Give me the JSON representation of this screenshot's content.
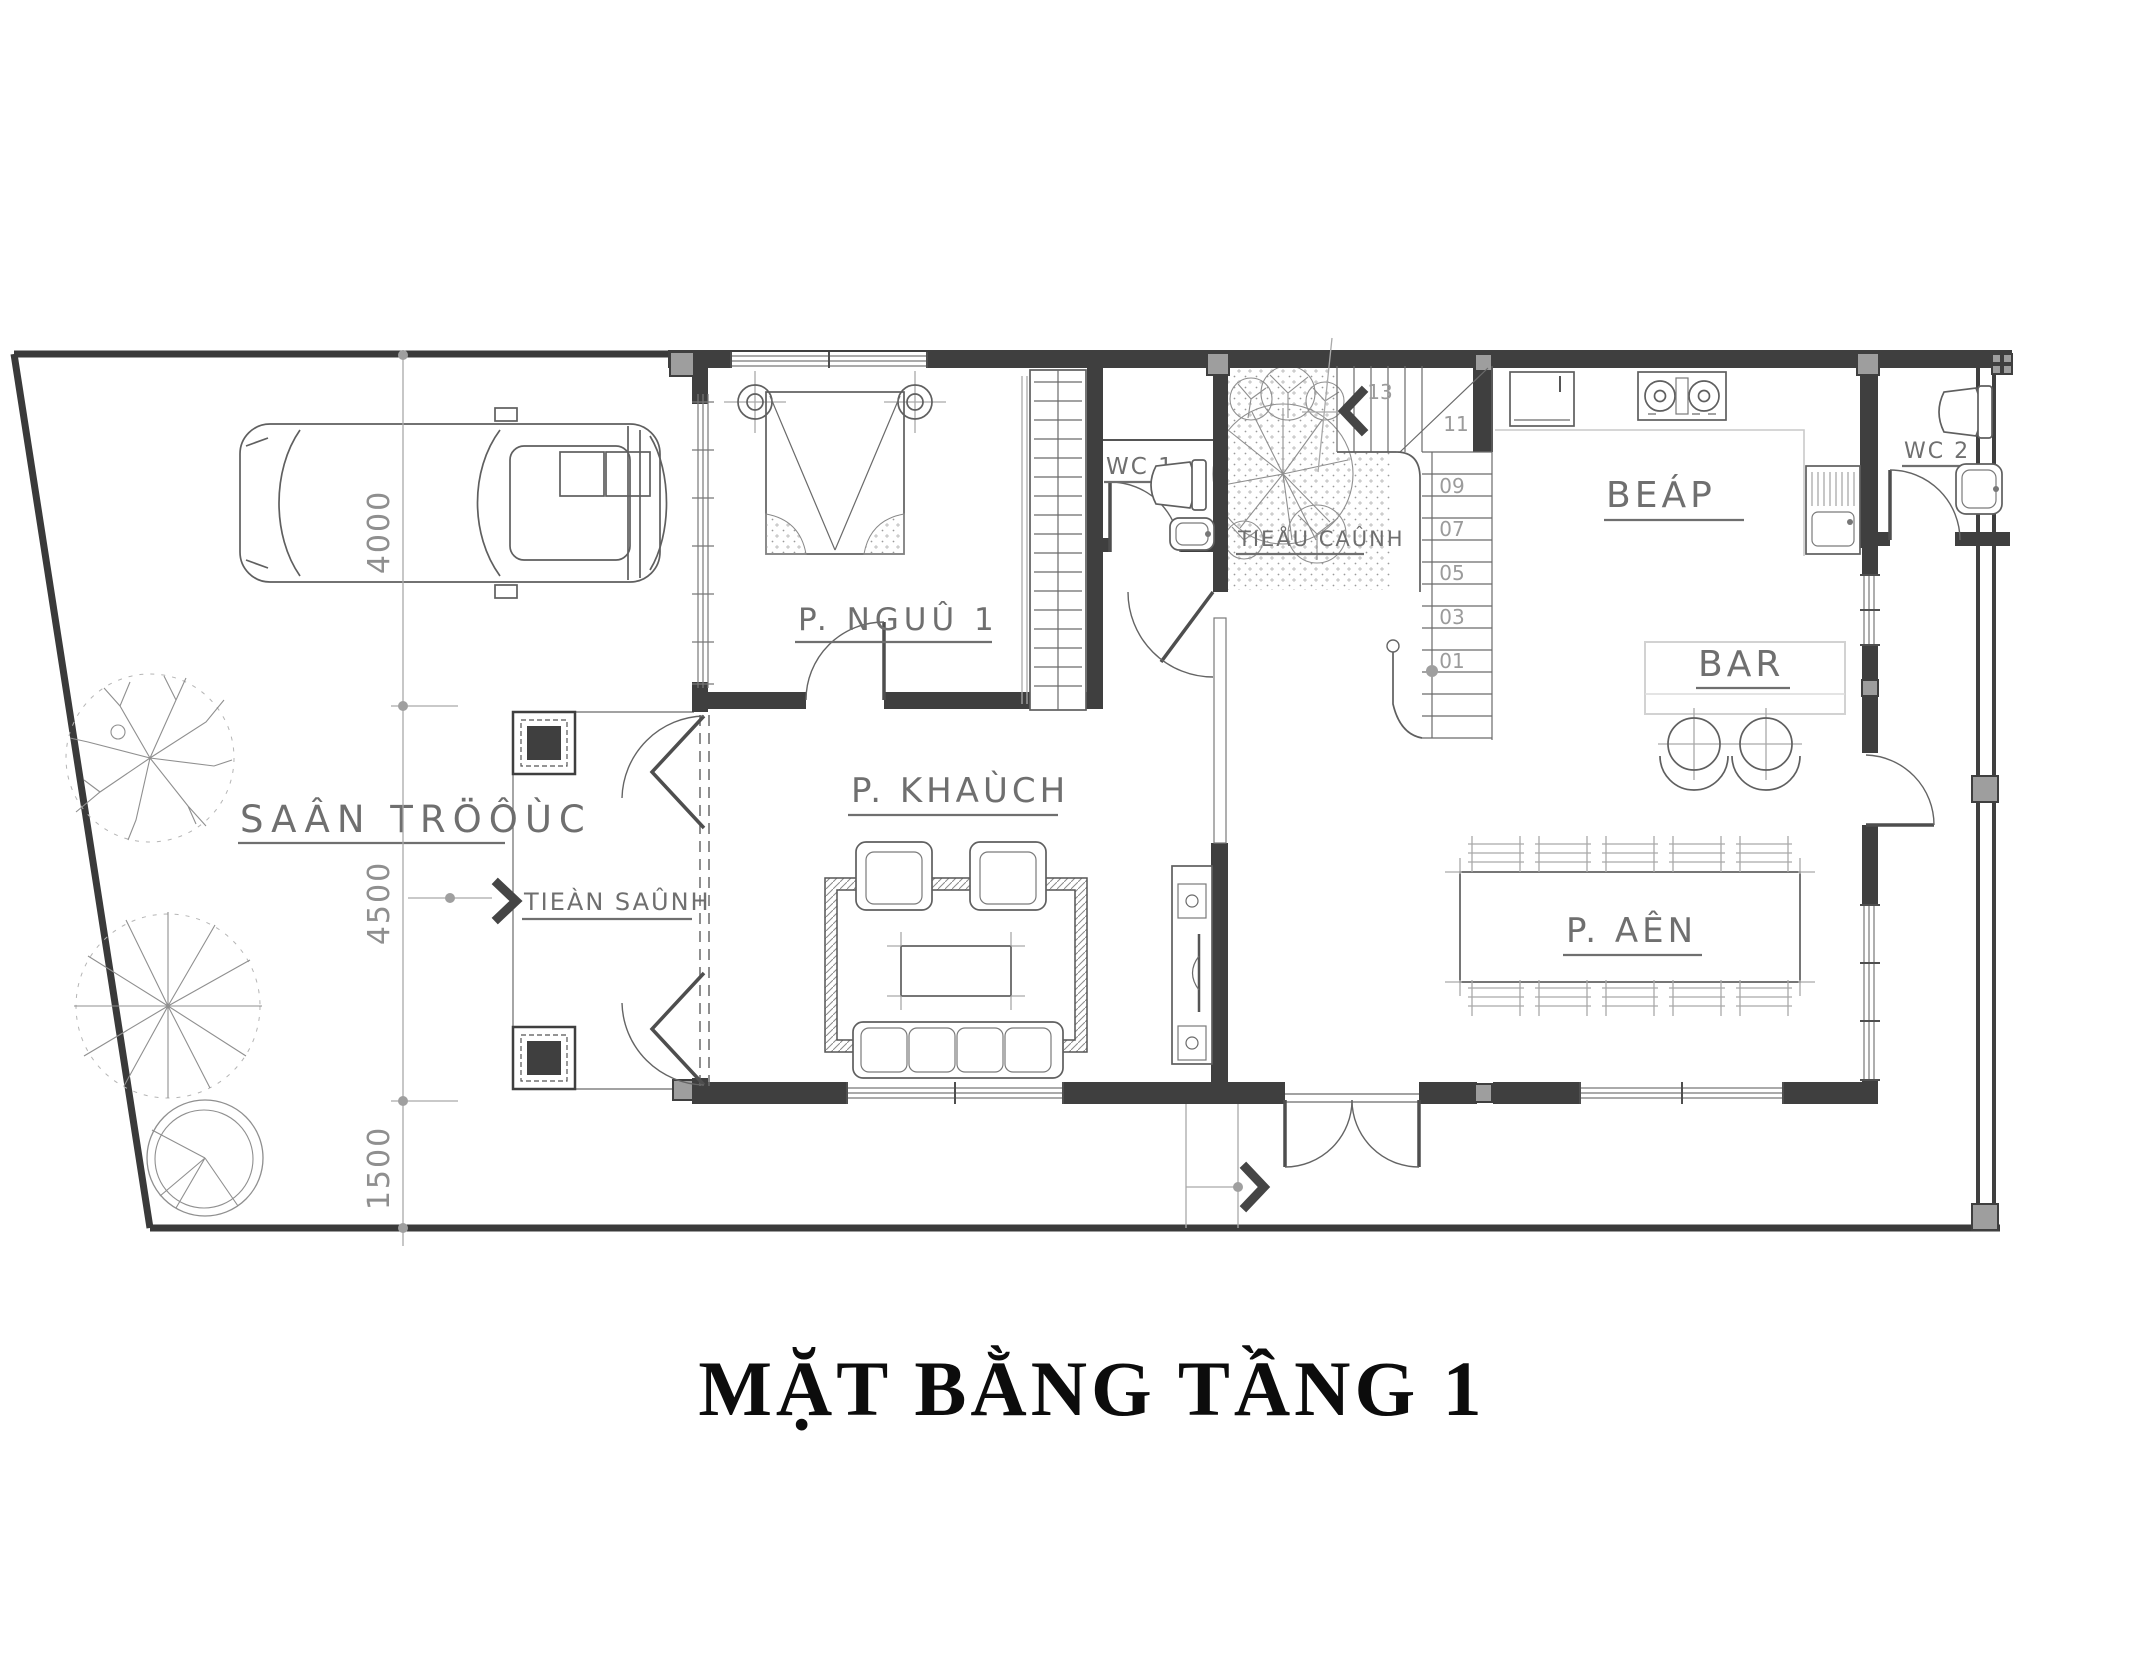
{
  "title": {
    "text": "MẶT BẰNG TẦNG 1"
  },
  "site": {
    "front_yard_label": "SAÂN TRÖÔÙC",
    "dimensions": [
      "4000",
      "4500",
      "1500"
    ]
  },
  "rooms": {
    "bedroom": "P. NGUÛ 1",
    "wc1": "WC 1",
    "garden": "TIEÅU CAÛNH",
    "kitchen": "BEÁP",
    "wc2": "WC 2",
    "bar": "BAR",
    "living": "P. KHAÙCH",
    "dining": "P. AÊN",
    "foyer": "TIEÀN SAÛNH"
  },
  "stairs": {
    "steps": [
      "01",
      "03",
      "05",
      "07",
      "09",
      "11",
      "13"
    ]
  },
  "colors": {
    "wall": "#3f3f3f",
    "line": "#6f6f6f",
    "light_line": "#9f9f9f",
    "column": "#9e9e9e",
    "title": "#0c0c0c",
    "background": "#ffffff"
  }
}
